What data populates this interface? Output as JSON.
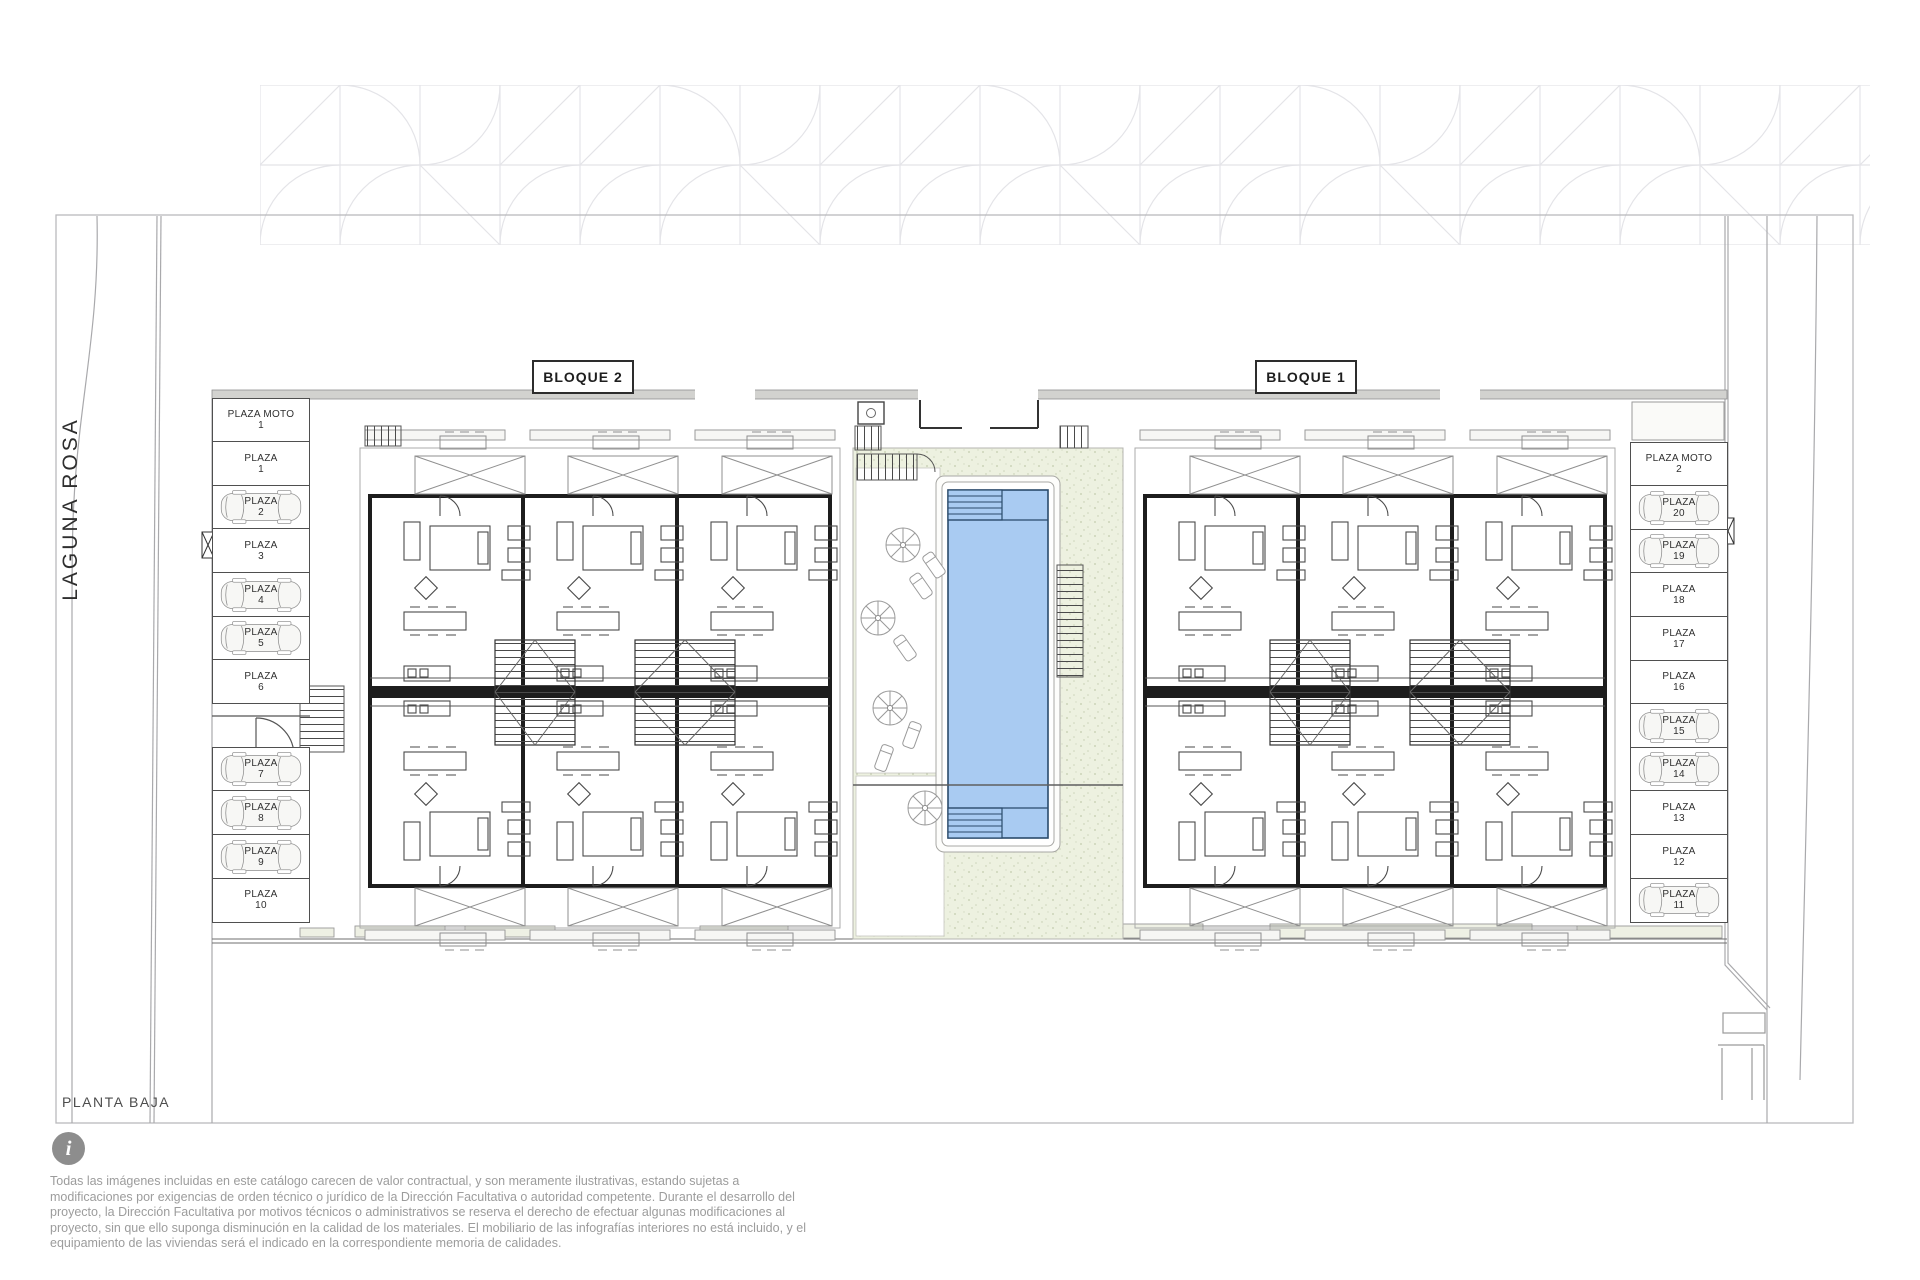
{
  "plan": {
    "title": "PLANTA BAJA",
    "street_label": "LAGUNA ROSA",
    "blocks": [
      {
        "label": "BLOQUE 2"
      },
      {
        "label": "BLOQUE 1"
      }
    ],
    "parking_left_upper": [
      {
        "name": "PLAZA MOTO",
        "number": "1",
        "car": false
      },
      {
        "name": "PLAZA",
        "number": "1",
        "car": false
      },
      {
        "name": "PLAZA",
        "number": "2",
        "car": true
      },
      {
        "name": "PLAZA",
        "number": "3",
        "car": false
      },
      {
        "name": "PLAZA",
        "number": "4",
        "car": true
      },
      {
        "name": "PLAZA",
        "number": "5",
        "car": true
      },
      {
        "name": "PLAZA",
        "number": "6",
        "car": false
      }
    ],
    "parking_left_lower": [
      {
        "name": "PLAZA",
        "number": "7",
        "car": true
      },
      {
        "name": "PLAZA",
        "number": "8",
        "car": true
      },
      {
        "name": "PLAZA",
        "number": "9",
        "car": true
      },
      {
        "name": "PLAZA",
        "number": "10",
        "car": false
      }
    ],
    "parking_right": [
      {
        "name": "PLAZA MOTO",
        "number": "2",
        "car": false
      },
      {
        "name": "PLAZA",
        "number": "20",
        "car": true
      },
      {
        "name": "PLAZA",
        "number": "19",
        "car": true
      },
      {
        "name": "PLAZA",
        "number": "18",
        "car": false
      },
      {
        "name": "PLAZA",
        "number": "17",
        "car": false
      },
      {
        "name": "PLAZA",
        "number": "16",
        "car": false
      },
      {
        "name": "PLAZA",
        "number": "15",
        "car": true
      },
      {
        "name": "PLAZA",
        "number": "14",
        "car": true
      },
      {
        "name": "PLAZA",
        "number": "13",
        "car": false
      },
      {
        "name": "PLAZA",
        "number": "12",
        "car": false
      },
      {
        "name": "PLAZA",
        "number": "11",
        "car": true
      }
    ],
    "colors": {
      "pool": "#a9cbf2",
      "pool_edge": "#2a4a6b",
      "deck": "#edf1e0",
      "wall": "#1d1d1d"
    }
  },
  "footer": {
    "info_glyph": "i",
    "disclaimer": "Todas las imágenes incluidas en este catálogo carecen de valor contractual, y son meramente ilustrativas, estando sujetas a modificaciones por exigencias de orden técnico o jurídico de la Dirección Facultativa o autoridad competente. Durante el desarrollo del proyecto, la Dirección Facultativa por motivos técnicos o administrativos se reserva el derecho de efectuar algunas modificaciones al proyecto, sin que ello suponga disminución en la calidad de los materiales. El mobiliario de las infografías interiores no está incluido, y el equipamiento de las viviendas será el indicado en la correspondiente memoria de calidades."
  }
}
